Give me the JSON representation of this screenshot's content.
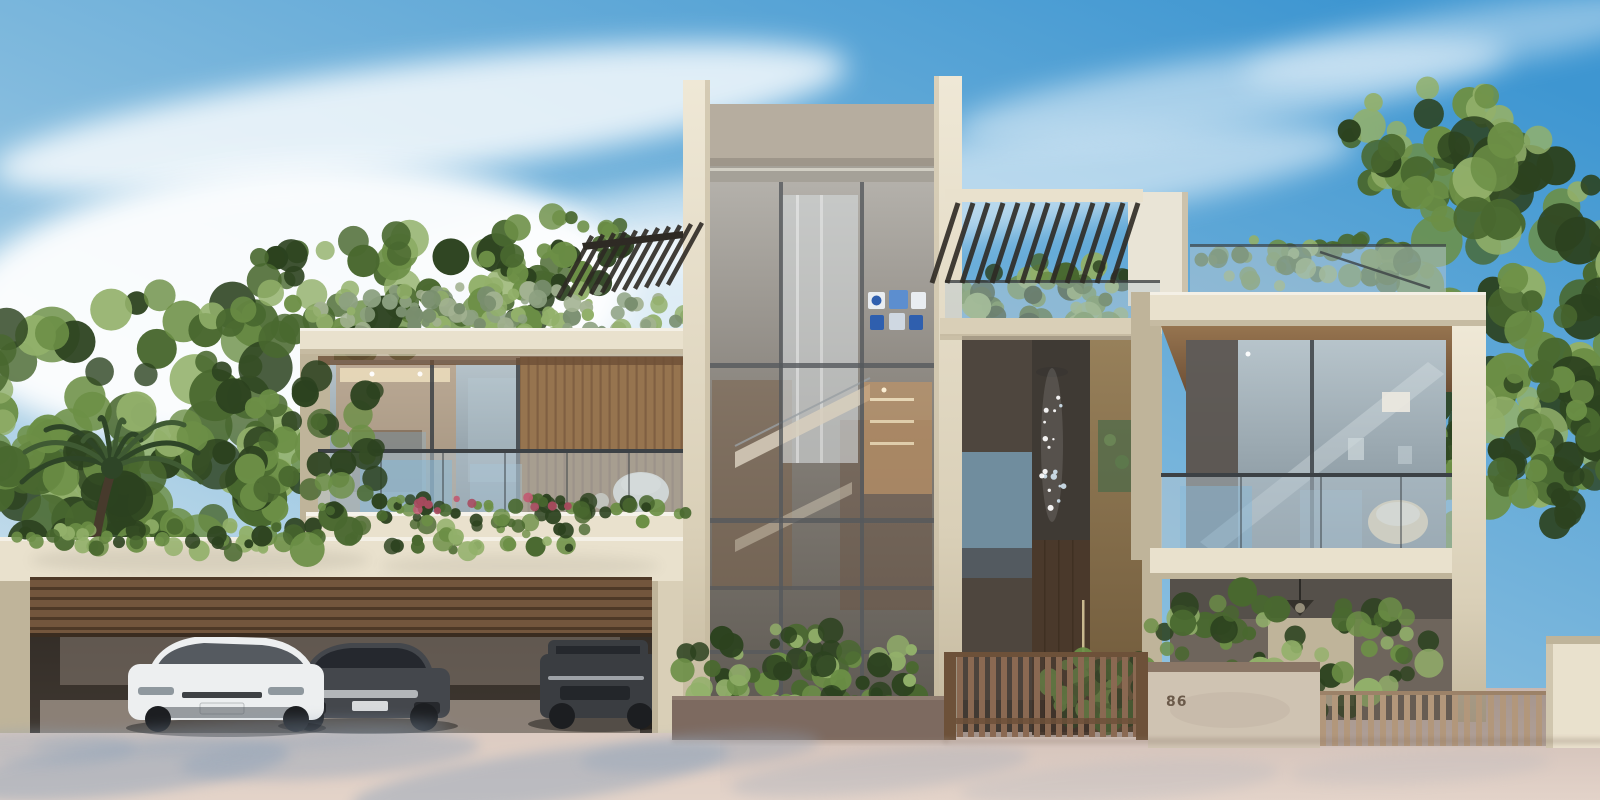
{
  "meta": {
    "type": "architectural-rendering",
    "description": "Photorealistic exterior rendering of a modern two-storey luxury villa with a central glass stair tower, rooftop pergolas and roof gardens, glass-railed balconies, a triple garage with slatted timber door and three parked cars, slatted entrance fences and a pink paved forecourt under a blue sky with wispy clouds."
  },
  "house_number": "86",
  "palette": {
    "sky_top": "#3e96d1",
    "sky_mid": "#85bcde",
    "sky_low": "#e2ecf1",
    "cloud": "#ffffff",
    "cream": "#d9cfb7",
    "cream_light": "#e9e1cd",
    "cream_dark": "#bfb49a",
    "pillar_hi": "#efe8d6",
    "pillar_lo": "#c3b79d",
    "tower_top": "#b6ad9f",
    "metal": "#a5a198",
    "metal_hi": "#d6d3c8",
    "glass_hi": "#b7c4cb",
    "glass_lo": "#7e8d96",
    "glass_blue": "#86b9da",
    "rail_dark": "#3c4145",
    "tglass_hi": "#b4b1ab",
    "tglass_mid": "#847f78",
    "tglass_lo": "#5c5750",
    "soffit": "#96744f",
    "soffit_dark": "#6d4f36",
    "interior_warm": "#bd9468",
    "interior_glow": "#ecdebd",
    "balustrade": "#b7c7d1",
    "wood_door": "#4a392b",
    "brass_hi": "#97805a",
    "brass_lo": "#6e5839",
    "slat_door": "#7d5e43",
    "slat_dark": "#553e2b",
    "fence": "#8a6952",
    "fence_light": "#b2977b",
    "fence_rail": "#6d5139",
    "planter_wall": "#7d6a60",
    "stucco": "#cfc3b2",
    "stucco_cap": "#8a7666",
    "garage_dark": "#3f3831",
    "garage_wall": "#8d8177",
    "garage_floor": "#a59a8f",
    "car_white": "#edeff0",
    "car_dark": "#44474c",
    "car_suv": "#3a3d41",
    "tire": "#1c1e21",
    "chrome": "#c7cacd",
    "car_glass": "#23262b",
    "ground_hi": "#e3d3c9",
    "ground_lo": "#c9b7b0",
    "shadow_blue": "#8fa2b8",
    "shadow_warm": "#8a7668",
    "f_dark": "#2c421f",
    "f_mid": "#49682f",
    "f_light": "#6c8f46",
    "f_pale": "#92b06a",
    "sage1": "#8da181",
    "sage2": "#a3b292",
    "sage3": "#798e6e",
    "flower": "#a84a5e",
    "flower2": "#c15b72",
    "trunk": "#473a2c",
    "pergola": "#2e2a24",
    "art_blue": "#2f5fae",
    "art_blue2": "#5c8ecf",
    "art_white": "#e9edf1",
    "number_color": "#6b5a4a"
  },
  "scene": {
    "clouds": [
      {
        "cx": 420,
        "cy": 118,
        "rx": 430,
        "ry": 55,
        "rot": -7,
        "o": 0.8
      },
      {
        "cx": 880,
        "cy": 200,
        "rx": 480,
        "ry": 48,
        "rot": -7,
        "o": 0.55
      },
      {
        "cx": 1230,
        "cy": 92,
        "rx": 280,
        "ry": 36,
        "rot": -8,
        "o": 0.5
      },
      {
        "cx": 290,
        "cy": 305,
        "rx": 340,
        "ry": 140,
        "rot": -4,
        "o": 0.95
      },
      {
        "cx": 680,
        "cy": 330,
        "rx": 210,
        "ry": 105,
        "rot": -4,
        "o": 0.75
      },
      {
        "cx": 1460,
        "cy": 40,
        "rx": 220,
        "ry": 30,
        "rot": -9,
        "o": 0.4
      }
    ],
    "foliage": [
      {
        "name": "left-trees-main",
        "layer": "back",
        "cx": 150,
        "cy": 420,
        "rx": 210,
        "ry": 130,
        "n": 105,
        "rmin": 10,
        "rmax": 28,
        "seed": 11,
        "colors": [
          "f_dark",
          "f_mid",
          "f_light",
          "f_pale"
        ]
      },
      {
        "name": "left-trees-low",
        "layer": "back",
        "cx": 60,
        "cy": 525,
        "rx": 130,
        "ry": 95,
        "n": 60,
        "rmin": 10,
        "rmax": 24,
        "seed": 12,
        "colors": [
          "f_dark",
          "f_mid",
          "f_dark",
          "f_light"
        ]
      },
      {
        "name": "left-roof-trees",
        "layer": "back",
        "cx": 380,
        "cy": 295,
        "rx": 170,
        "ry": 60,
        "n": 65,
        "rmin": 8,
        "rmax": 20,
        "seed": 13,
        "colors": [
          "f_mid",
          "f_light",
          "f_pale",
          "f_dark"
        ]
      },
      {
        "name": "pergola-back-trees",
        "layer": "back",
        "cx": 565,
        "cy": 255,
        "rx": 80,
        "ry": 42,
        "n": 35,
        "rmin": 6,
        "rmax": 14,
        "seed": 14,
        "colors": [
          "f_mid",
          "f_light",
          "f_dark"
        ]
      },
      {
        "name": "left-roof-grass",
        "layer": "back",
        "cx": 500,
        "cy": 312,
        "rx": 205,
        "ry": 26,
        "n": 95,
        "rmin": 4,
        "rmax": 10,
        "seed": 15,
        "colors": [
          "sage1",
          "sage2",
          "sage3",
          "f_pale"
        ]
      },
      {
        "name": "mid-roof-plants",
        "layer": "back",
        "cx": 1045,
        "cy": 298,
        "rx": 100,
        "ry": 38,
        "n": 50,
        "rmin": 6,
        "rmax": 14,
        "seed": 16,
        "colors": [
          "f_mid",
          "f_light",
          "f_dark",
          "f_pale"
        ]
      },
      {
        "name": "right-roof-plants",
        "layer": "back",
        "cx": 1315,
        "cy": 262,
        "rx": 130,
        "ry": 26,
        "n": 45,
        "rmin": 5,
        "rmax": 12,
        "seed": 17,
        "colors": [
          "f_mid",
          "f_light",
          "f_pale"
        ]
      },
      {
        "name": "right-trees-top",
        "layer": "back",
        "cx": 1430,
        "cy": 150,
        "rx": 95,
        "ry": 70,
        "n": 45,
        "rmin": 8,
        "rmax": 18,
        "seed": 18,
        "colors": [
          "f_mid",
          "f_light",
          "f_dark",
          "f_pale"
        ]
      },
      {
        "name": "right-trees-main",
        "layer": "back",
        "cx": 1505,
        "cy": 320,
        "rx": 140,
        "ry": 190,
        "n": 110,
        "rmin": 10,
        "rmax": 26,
        "seed": 19,
        "colors": [
          "f_dark",
          "f_mid",
          "f_light",
          "f_pale"
        ]
      },
      {
        "name": "right-trees-mid",
        "layer": "back",
        "cx": 1390,
        "cy": 480,
        "rx": 85,
        "ry": 85,
        "n": 50,
        "rmin": 8,
        "rmax": 18,
        "seed": 20,
        "colors": [
          "f_dark",
          "f_mid",
          "f_light"
        ]
      },
      {
        "name": "garage-hedge",
        "layer": "mid",
        "cx": 320,
        "cy": 538,
        "rx": 330,
        "ry": 15,
        "n": 85,
        "rmin": 4,
        "rmax": 11,
        "seed": 21,
        "colors": [
          "f_mid",
          "f_dark",
          "f_light",
          "f_pale"
        ]
      },
      {
        "name": "left-wing-overlap",
        "layer": "mid",
        "cx": 318,
        "cy": 455,
        "rx": 75,
        "ry": 100,
        "n": 45,
        "rmin": 8,
        "rmax": 18,
        "seed": 22,
        "colors": [
          "f_dark",
          "f_mid",
          "f_light"
        ]
      },
      {
        "name": "balcony-planter",
        "layer": "mid",
        "cx": 500,
        "cy": 512,
        "rx": 190,
        "ry": 15,
        "n": 60,
        "rmin": 4,
        "rmax": 9,
        "seed": 23,
        "colors": [
          "f_dark",
          "f_mid",
          "f_light"
        ]
      },
      {
        "name": "balcony-roses",
        "layer": "mid",
        "cx": 510,
        "cy": 503,
        "rx": 150,
        "ry": 9,
        "n": 11,
        "rmin": 3,
        "rmax": 5,
        "seed": 24,
        "colors": [
          "flower",
          "flower2",
          "flower"
        ]
      },
      {
        "name": "tower-base-shrubs",
        "layer": "mid",
        "cx": 800,
        "cy": 678,
        "rx": 135,
        "ry": 50,
        "n": 85,
        "rmin": 5,
        "rmax": 13,
        "seed": 25,
        "colors": [
          "f_mid",
          "f_light",
          "f_dark",
          "f_pale"
        ]
      },
      {
        "name": "entry-shrub",
        "layer": "mid",
        "cx": 1105,
        "cy": 688,
        "rx": 58,
        "ry": 40,
        "n": 42,
        "rmin": 5,
        "rmax": 12,
        "seed": 26,
        "colors": [
          "f_dark",
          "f_mid",
          "f_light"
        ]
      },
      {
        "name": "right-low-bushes",
        "layer": "mid",
        "cx": 1280,
        "cy": 652,
        "rx": 155,
        "ry": 64,
        "n": 90,
        "rmin": 6,
        "rmax": 15,
        "seed": 27,
        "colors": [
          "f_dark",
          "f_mid",
          "f_light",
          "f_pale"
        ]
      },
      {
        "name": "right-edge-overlap",
        "layer": "mid",
        "cx": 1565,
        "cy": 430,
        "rx": 70,
        "ry": 95,
        "n": 40,
        "rmin": 8,
        "rmax": 18,
        "seed": 28,
        "colors": [
          "f_mid",
          "f_light",
          "f_dark"
        ]
      }
    ],
    "pergolas": [
      {
        "name": "left-roof-pergola",
        "x": 592,
        "y": 236,
        "count": 11,
        "step": 11,
        "slope": -0.12,
        "dx": -34,
        "dy": 62,
        "w": 4.5
      },
      {
        "name": "mid-roof-pergola",
        "x": 958,
        "y": 203,
        "count": 13,
        "step": 15,
        "slope": 0,
        "dx": -26,
        "dy": 80,
        "w": 5
      }
    ],
    "palm": {
      "cx": 112,
      "cy": 468,
      "n": 10,
      "len": 88,
      "seed": 31
    },
    "chandelier": {
      "x": 1052,
      "ytop": 368,
      "ybot": 522,
      "n": 18,
      "seed": 32
    },
    "ground_shadows": [
      {
        "cx": 120,
        "cy": 770,
        "rx": 170,
        "ry": 26,
        "rot": -6,
        "o": 0.5
      },
      {
        "cx": 330,
        "cy": 756,
        "rx": 150,
        "ry": 22,
        "rot": -4,
        "o": 0.42
      },
      {
        "cx": 540,
        "cy": 778,
        "rx": 190,
        "ry": 26,
        "rot": -8,
        "o": 0.46
      },
      {
        "cx": 700,
        "cy": 752,
        "rx": 120,
        "ry": 18,
        "rot": -5,
        "o": 0.34
      },
      {
        "cx": 240,
        "cy": 736,
        "rx": 210,
        "ry": 15,
        "rot": -3,
        "o": 0.3
      },
      {
        "cx": 40,
        "cy": 748,
        "rx": 95,
        "ry": 18,
        "rot": 0,
        "o": 0.36
      },
      {
        "cx": 880,
        "cy": 772,
        "rx": 150,
        "ry": 20,
        "rot": -6,
        "o": 0.24
      },
      {
        "cx": 1120,
        "cy": 782,
        "rx": 160,
        "ry": 20,
        "rot": -4,
        "o": 0.16
      },
      {
        "cx": 1420,
        "cy": 768,
        "rx": 130,
        "ry": 16,
        "rot": -3,
        "o": 0.12
      }
    ]
  }
}
